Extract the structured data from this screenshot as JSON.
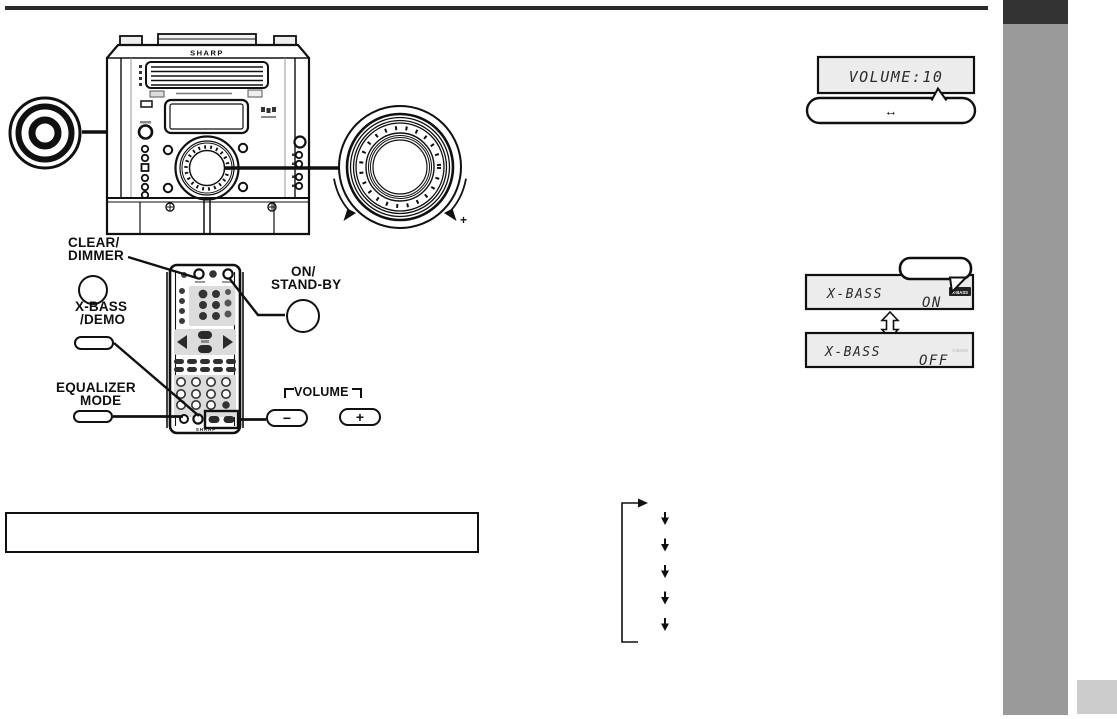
{
  "page": {
    "background": "#ffffff",
    "ink": "#1a1a1a",
    "sidebar_dark": "#333333",
    "sidebar_gray": "#9a9a9a",
    "page_tab_gray": "#cccccc",
    "display_bg": "#ececec"
  },
  "main_unit": {
    "brand": "SHARP",
    "knob_plus": "+"
  },
  "remote": {
    "brand": "SHARP"
  },
  "callouts": {
    "clear_dimmer": {
      "line1": "CLEAR/",
      "line2": "DIMMER"
    },
    "xbass_demo": {
      "line1": "X-BASS",
      "line2": "/DEMO"
    },
    "equalizer_mode": {
      "line1": "EQUALIZER",
      "line2": "MODE"
    },
    "on_standby": {
      "line1": "ON/",
      "line2": "STAND-BY"
    },
    "volume": {
      "label": "VOLUME",
      "minus": "−",
      "plus": "+"
    }
  },
  "displays": {
    "volume": {
      "text": "VOLUME:10",
      "bubble_arrow": "↔"
    },
    "xbass_on": {
      "label": "X-BASS",
      "value": "ON",
      "indicator": "X-BASS"
    },
    "xbass_off": {
      "label": "X-BASS",
      "value": "OFF",
      "indicator": "X-BASS"
    }
  },
  "flow": {
    "steps": 5
  },
  "note_box": {
    "text": ""
  }
}
